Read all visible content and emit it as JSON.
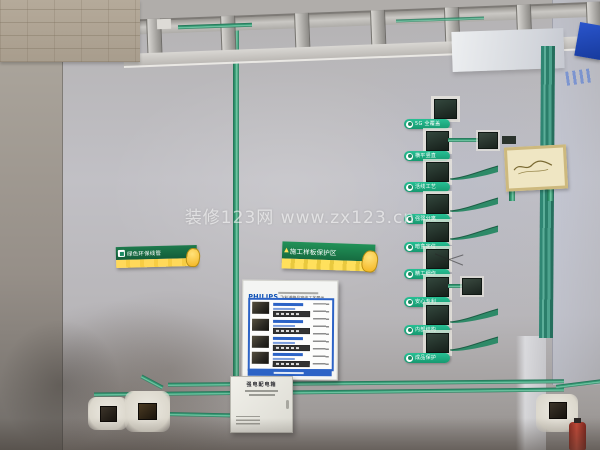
{
  "watermark": {
    "text": "装修123网 www.zx123.cn"
  },
  "conduit_labels": {
    "rows": [
      {
        "label": "5G 全覆盖"
      },
      {
        "label": "横平竖直"
      },
      {
        "label": "活线工艺"
      },
      {
        "label": "强弱分离"
      },
      {
        "label": "暗盒定位"
      },
      {
        "label": "精工细作"
      },
      {
        "label": "安心专利"
      },
      {
        "label": "内部结构"
      },
      {
        "label": "成品保护"
      }
    ]
  },
  "signs": {
    "left": {
      "title": "绿色环保线管"
    },
    "middle": {
      "title": "施工样板保护区",
      "warning_glyph": "▲"
    }
  },
  "poster": {
    "brand": "PHILIPS",
    "title": "飞利浦精品穿线工艺展示"
  },
  "distribution_box": {
    "title": "强电配电箱"
  },
  "colors": {
    "conduit_green": "#2e8a68",
    "label_green": "#27c094",
    "sign_green": "#1d8a52",
    "sign_yellow": "#ffd95a",
    "philips_blue": "#2c63c6",
    "wall_gray": "#bfc0c6"
  }
}
